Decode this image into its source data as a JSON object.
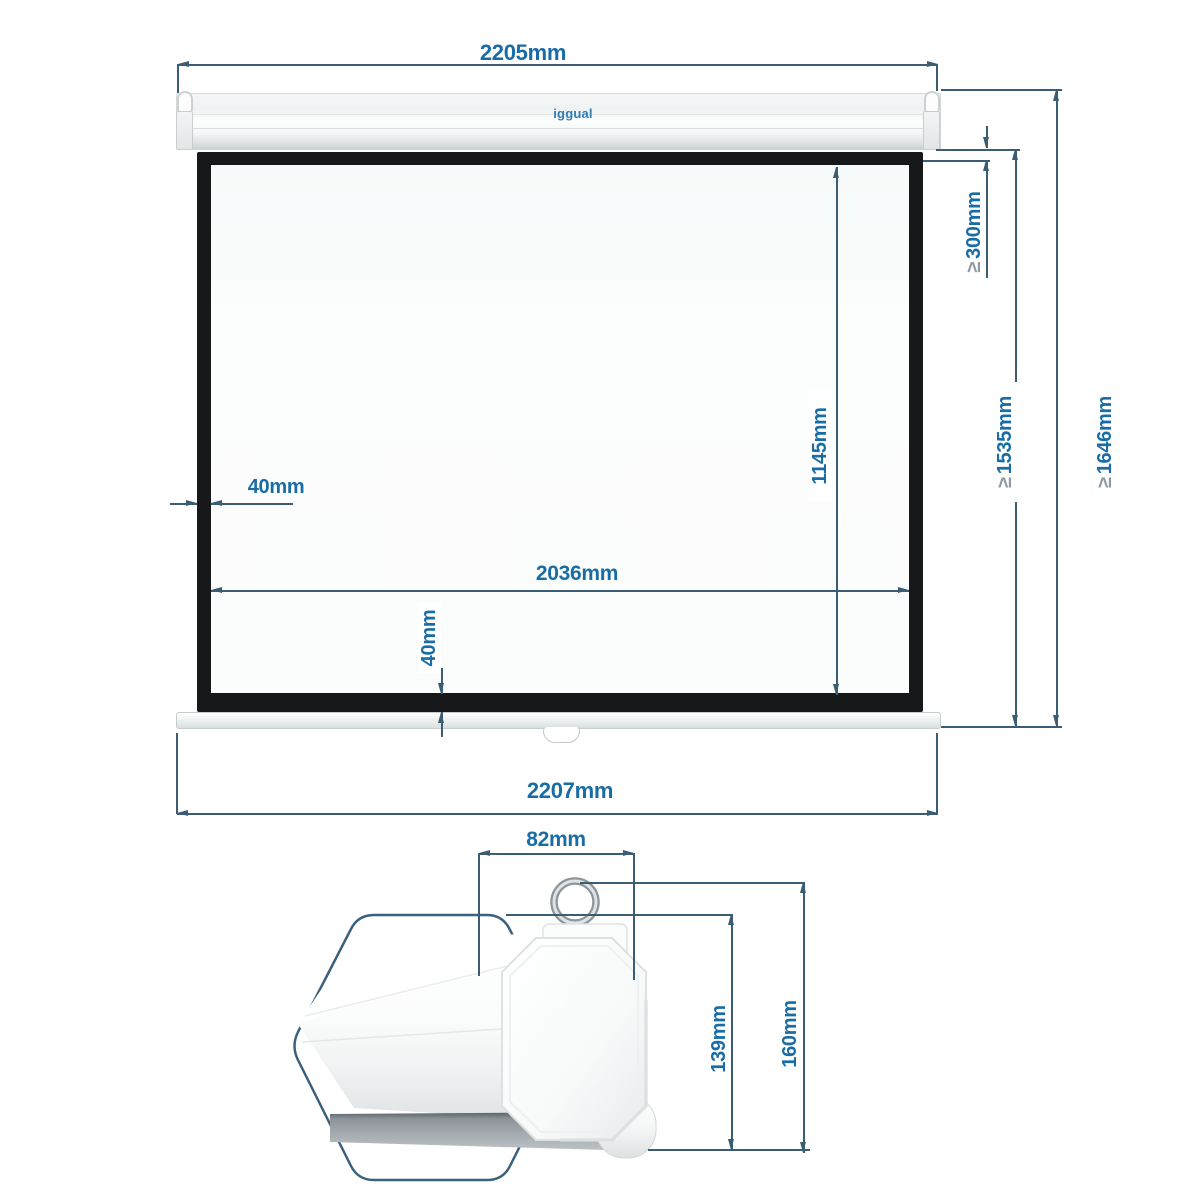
{
  "logo": {
    "text": "iggual",
    "color": "#2e7cb4"
  },
  "front_view": {
    "top_width": "2205mm",
    "bottom_width": "2207mm",
    "viewing_width": "2036mm",
    "viewing_height": "1145mm",
    "border_left": "40mm",
    "border_bottom": "40mm",
    "black_drop": {
      "symbol": "≥",
      "value": "300mm"
    },
    "height_below_case": {
      "symbol": "≥",
      "value": "1535mm"
    },
    "total_height": {
      "symbol": "≥",
      "value": "1646mm"
    }
  },
  "side_view": {
    "case_width": "82mm",
    "case_height": "139mm",
    "total_depth": "160mm"
  },
  "colors": {
    "dimension_line": "#3b5d74",
    "dimension_label": "#1a6ca5",
    "geq_symbol": "#8f99a2",
    "frame_black": "#17181a"
  }
}
